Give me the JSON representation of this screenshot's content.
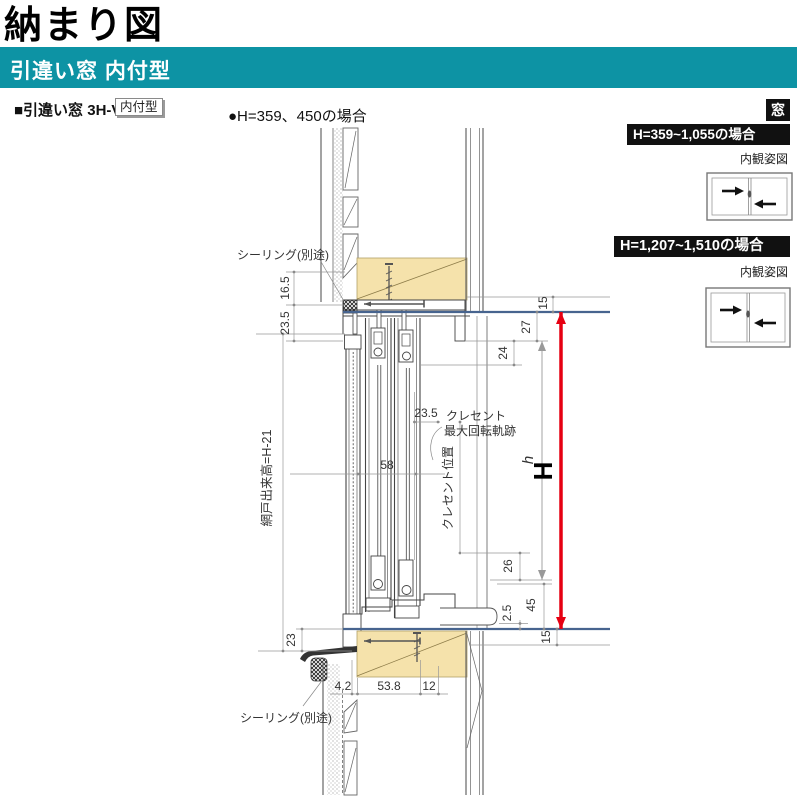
{
  "title": "納まり図",
  "band": {
    "label": "引違い窓 内付型"
  },
  "subtitle": {
    "series": "■引違い窓 3H-V",
    "type_badge": "内付型",
    "case_note": "●H=359、450の場合"
  },
  "side_panel": {
    "corner_tag": "窓",
    "case1": {
      "heading": "H=359~1,055の場合",
      "caption": "内観姿図"
    },
    "case2": {
      "heading": "H=1,207~1,510の場合",
      "caption": "内観姿図"
    }
  },
  "drawing": {
    "labels": {
      "sealing_top": "シーリング(別途)",
      "sealing_bottom": "シーリング(別途)",
      "screen_height": "網戸出来高=H-21",
      "crescent_l1": "クレセント",
      "crescent_l2": "最大回転軌跡",
      "crescent_pos": "クレセント位置"
    },
    "dims": {
      "left_165": "16.5",
      "left_235": "23.5",
      "left_23": "23",
      "top_15": "15",
      "right_27": "27",
      "right_24": "24",
      "mid_235": "23.5",
      "inner_58": "58",
      "right_26": "26",
      "right_45": "45",
      "right_25": "2.5",
      "bottom_15": "15",
      "bot_42": "4.2",
      "bot_538": "53.8",
      "bot_12": "12",
      "h_small": "h",
      "h_big": "H"
    },
    "colors": {
      "accent_teal": "#0d93a4",
      "bar_black": "#111111",
      "wood_fill": "#f5e2ab",
      "dimension_red": "#e60012",
      "frame_blue": "#47648f"
    }
  }
}
